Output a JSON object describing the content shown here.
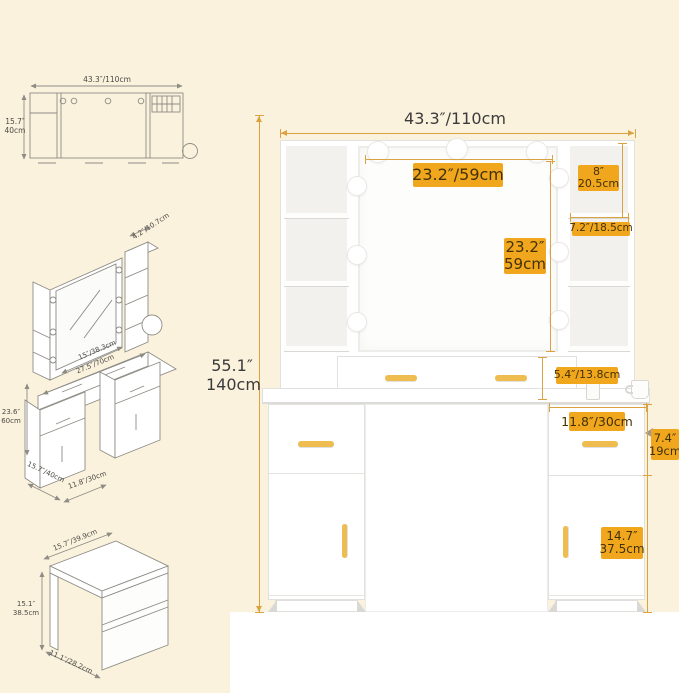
{
  "colors": {
    "background": "#fbf2de",
    "badge": "#f0a71e",
    "badge_text": "#433106",
    "dimension_line": "#dba242",
    "handle_gold": "#eebc4f"
  },
  "thumbnails": {
    "top_view": {
      "width": "43.3″/110cm",
      "depth_in": "15.7″",
      "depth_cm": "40cm"
    },
    "iso_view": {
      "shelf_depth": "4.2″/10.7cm",
      "mirror_width": "15″/38.3cm",
      "tabletop_width": "27.5″/70cm",
      "height_in": "23.6″",
      "height_cm": "60cm",
      "base_depth": "15.7″/40cm",
      "cabinet_width": "11.8″/30cm"
    },
    "stool": {
      "width": "15.7″/39.9cm",
      "height_in": "15.1″",
      "height_cm": "38.5cm",
      "depth": "11.1″/28.2cm"
    }
  },
  "main": {
    "overall_width": "43.3″/110cm",
    "overall_height_in": "55.1″",
    "overall_height_cm": "140cm",
    "mirror_width": "23.2″/59cm",
    "mirror_height_in": "23.2″",
    "mirror_height_cm": "59cm",
    "side_shelf_height_in": "8″",
    "side_shelf_height_cm": "20.5cm",
    "side_shelf_depth": "7.2″/18.5cm",
    "top_drawer_height": "5.4″/13.8cm",
    "cabinet_width": "11.8″/30cm",
    "cabinet_drawer_height_in": "7.4″",
    "cabinet_drawer_height_cm": "19cm",
    "cabinet_door_height_in": "14.7″",
    "cabinet_door_height_cm": "37.5cm"
  }
}
